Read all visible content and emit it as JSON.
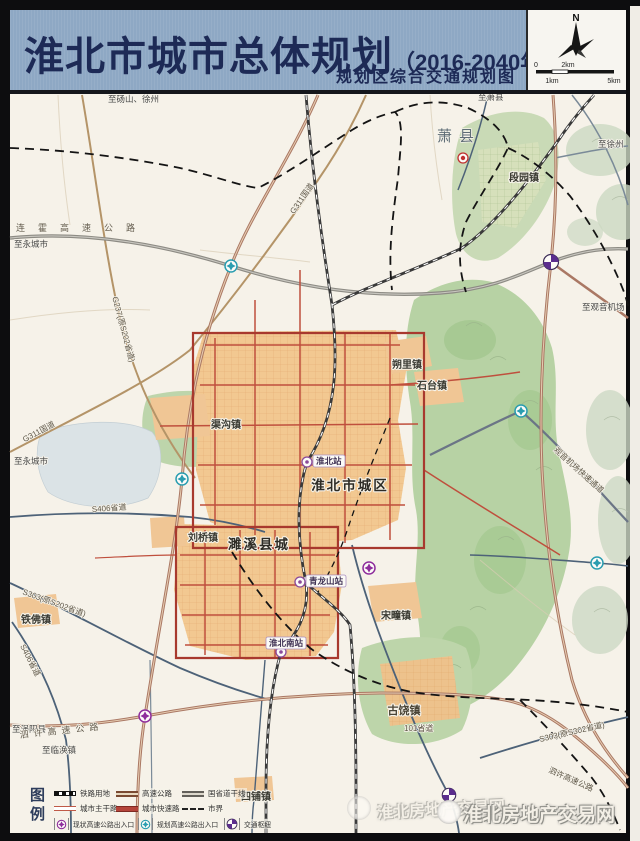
{
  "header": {
    "title": "淮北市城市总体规划",
    "title_suffix": "（2016-2040年）",
    "subtitle": "规划区综合交通规划图",
    "compass_n": "N",
    "scale_0": "0",
    "scale_1km": "1km",
    "scale_2km": "2km",
    "scale_5km": "5km"
  },
  "map": {
    "labels": {
      "to_dangshan_xuzhou": "至砀山、徐州",
      "to_xiaoxian": "至萧县",
      "to_xuzhou": "至徐州",
      "xiaoxian": "萧县",
      "duanyuan": "段园镇",
      "lianhuo_expwy": "连霍高速公路",
      "g311_north": "G311国道",
      "g311_west": "G311国道",
      "g237": "G237(原S202省道)",
      "to_yongcheng_1": "至永城市",
      "to_yongcheng_2": "至永城市",
      "qugou": "渠沟镇",
      "shuoli": "朔里镇",
      "shitai": "石台镇",
      "huaibei_station": "淮北站",
      "huaibei_city": "淮北市城区",
      "liuqiao": "刘桥镇",
      "suixi_city": "濉溪县城",
      "qinglongshan_station": "青龙山站",
      "songtuan": "宋疃镇",
      "tiefo": "铁佛镇",
      "huaibei_south_station": "淮北南站",
      "gurao": "古饶镇",
      "sipu": "四铺镇",
      "to_guoyang": "至涡阳县",
      "to_linhuan": "至临涣镇",
      "sixu_expwy_west": "泗许高速公路",
      "sixu_expwy_east": "泗许高速公路",
      "s406_east": "S406省道",
      "s406_south": "S406省道",
      "s303_west": "S303(原S202省道)",
      "s303_east": "S303(原S302省道)",
      "to_guanyin_airport": "至观音机场",
      "airport_expressway": "观音机场快速通道",
      "s101": "101省道"
    }
  },
  "legend": {
    "title": "图例",
    "items": [
      {
        "label": "铁路用地",
        "type": "railway"
      },
      {
        "label": "高速公路",
        "type": "expressway"
      },
      {
        "label": "国省道干线",
        "type": "national-road"
      },
      {
        "label": "城市主干路",
        "type": "arterial"
      },
      {
        "label": "城市快速路",
        "type": "urban-expressway"
      },
      {
        "label": "市界",
        "type": "boundary"
      },
      {
        "label": "现状高速公路出入口",
        "type": "existing-interchange"
      },
      {
        "label": "规划高速公路出入口",
        "type": "planned-interchange"
      },
      {
        "label": "交通枢纽",
        "type": "hub"
      }
    ]
  },
  "watermark": {
    "text": "淮北房地产交易网"
  },
  "colors": {
    "header_bg": "#8ea8c4",
    "title_text": "#1d2a56",
    "existing_interchange": "#8e2d9c",
    "planned_interchange": "#2a9db0",
    "hub": "#5b2d8e",
    "urban_area": "#f2c891",
    "terrain_green": "#b7d2a4"
  }
}
